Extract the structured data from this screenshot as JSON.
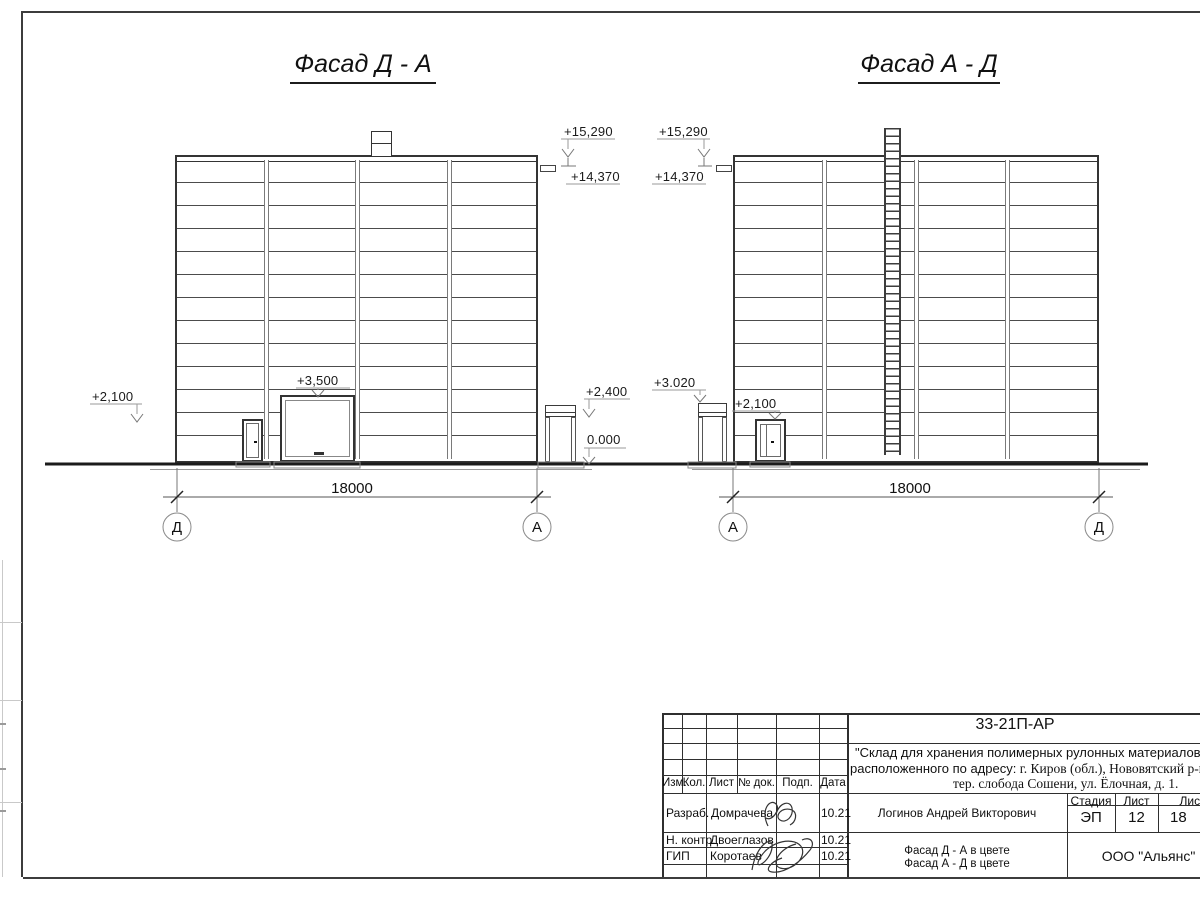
{
  "titles": {
    "left": "Фасад Д - А",
    "right": "Фасад А - Д"
  },
  "left_facade": {
    "elev_left": "+2,100",
    "elev_gate": "+3,500",
    "elev_roof": "+15,290",
    "elev_parapet": "+14,370",
    "elev_canopy": "+2,400",
    "elev_zero": "0.000",
    "dim": "18000",
    "axis_left": "Д",
    "axis_right": "А"
  },
  "right_facade": {
    "elev_roof": "+15,290",
    "elev_parapet": "+14,370",
    "elev_canopy": "+3.020",
    "elev_door": "+2,100",
    "dim": "18000",
    "axis_left": "А",
    "axis_right": "Д"
  },
  "titleblock": {
    "code": "33-21П-АР",
    "name1": "\"Склад для хранения полимерных рулонных материалов\"",
    "name2a": "расположенного по адресу:",
    "name2b": " г. Киров (обл.), Нововятский р-н,",
    "name3": "тер. слобода Сошени, ул. Ёлочная, д. 1.",
    "cols": {
      "izm": "Изм.",
      "kol": "Кол.",
      "list": "Лист",
      "ndok": "№ док.",
      "podp": "Подп.",
      "data": "Дата"
    },
    "rows": [
      {
        "role": "Разраб.",
        "name": "Домрачева",
        "date": "10.21"
      },
      {
        "role": "Н. контр.",
        "name": "Двоеглазов",
        "date": "10.21"
      },
      {
        "role": "ГИП",
        "name": "Коротаев",
        "date": "10.21"
      }
    ],
    "person": "Логинов Андрей Викторович",
    "sheet_title1": "Фасад Д - А в цвете",
    "sheet_title2": "Фасад А - Д в цвете",
    "stage_label": "Стадия",
    "sheet_label": "Лист",
    "sheets_label": "Листов",
    "stage_value": "ЭП",
    "sheet_value": "12",
    "sheets_value": "18",
    "company": "ООО \"Альянс\""
  }
}
